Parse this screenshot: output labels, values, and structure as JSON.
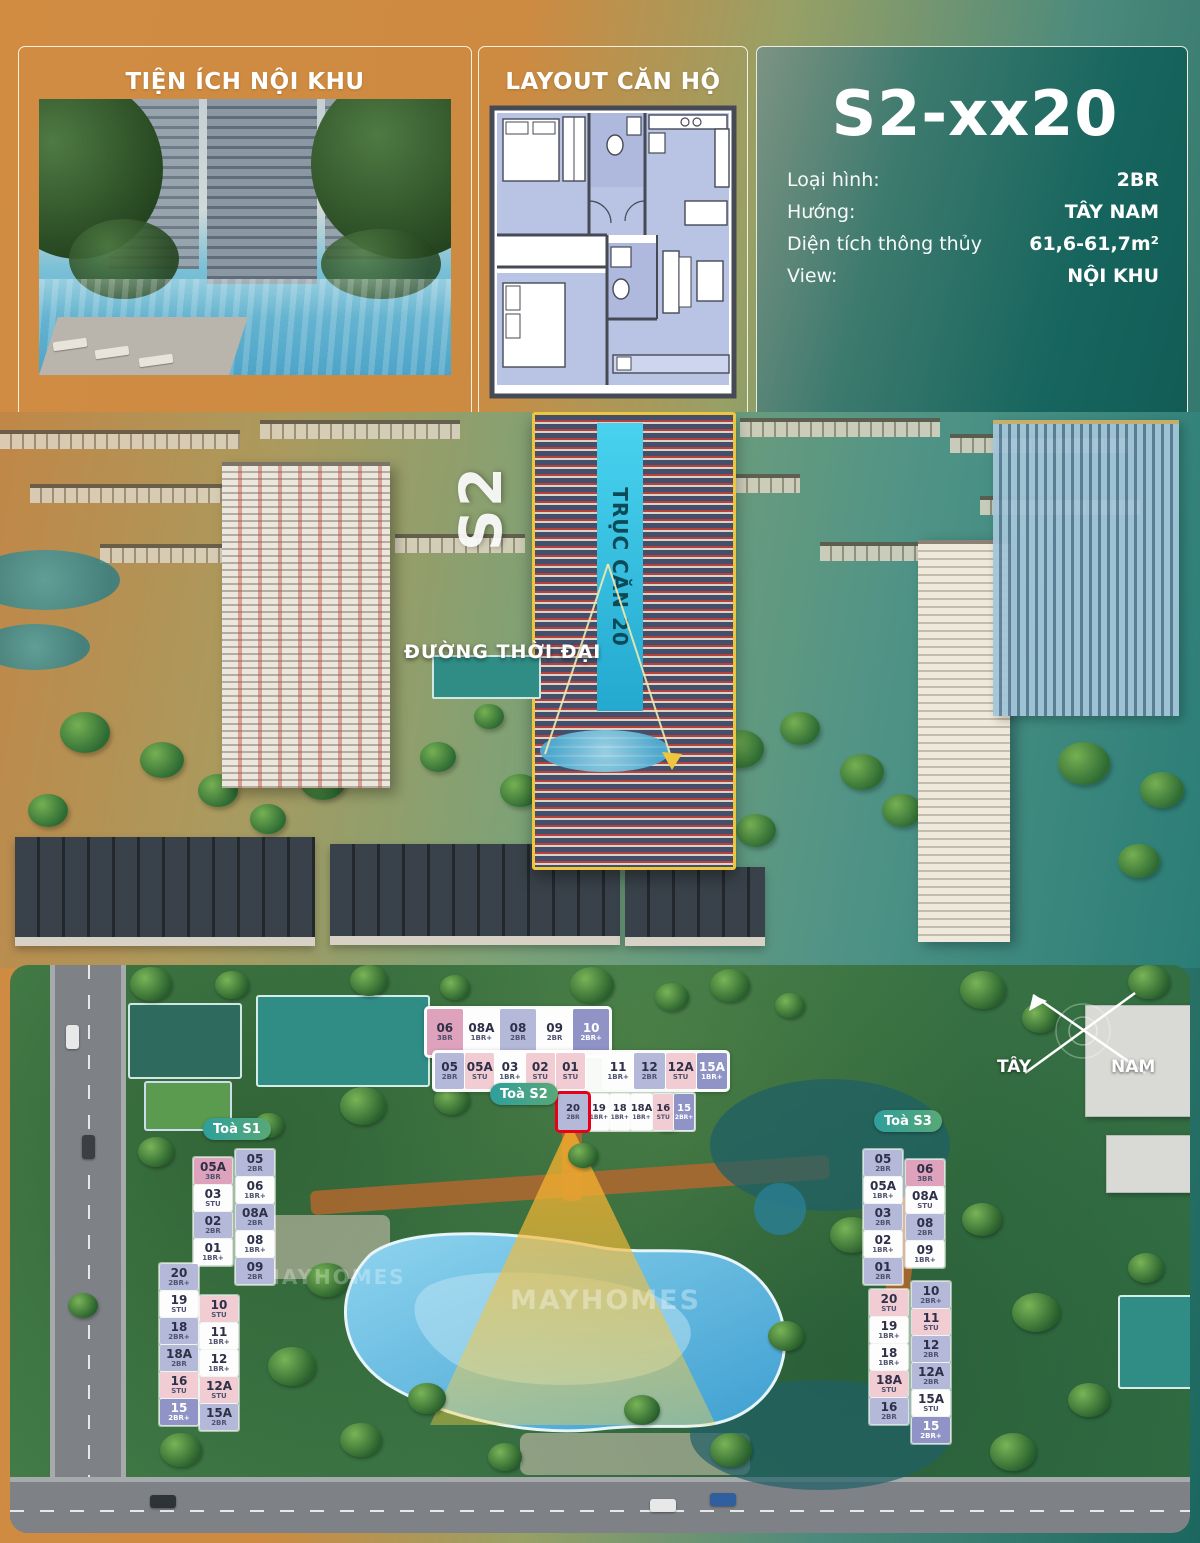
{
  "top": {
    "amenities_title": "TIỆN ÍCH NỘI KHU",
    "layout_title": "LAYOUT CĂN HỘ",
    "unit": {
      "code": "S2-xx20",
      "specs": [
        {
          "label": "Loại hình:",
          "value": "2BR"
        },
        {
          "label": "Hướng:",
          "value": "TÂY NAM"
        },
        {
          "label": "Diện tích thông thủy",
          "value": "61,6-61,7m²"
        },
        {
          "label": "View:",
          "value": "NỘI KHU"
        }
      ]
    }
  },
  "aerial": {
    "tower_code": "S2",
    "axis_label": "TRỤC CĂN 20",
    "road_label": "ĐƯỜNG THỜI ĐẠI"
  },
  "siteplan": {
    "watermark": "MAYHOMES",
    "compass": {
      "west": "TÂY",
      "south": "NAM"
    },
    "pills": {
      "s1": "Toà S1",
      "s2": "Toà S2",
      "s3": "Toà S3"
    },
    "colors": {
      "highlight_red": "#e8001a",
      "type_3br": "#dfa2bc",
      "type_2br": "#b4b8d9",
      "type_2br_plus": "#8f93c5",
      "type_1br_plus": "#fdfdfe",
      "type_stu": "#f1ccd3"
    },
    "grids": {
      "s2_r1": [
        {
          "no": "06",
          "type": "3BR",
          "variant": "pink"
        },
        {
          "no": "08A",
          "type": "1BR+",
          "variant": "white"
        },
        {
          "no": "08",
          "type": "2BR",
          "variant": "lav"
        },
        {
          "no": "09",
          "type": "2BR",
          "variant": "white"
        },
        {
          "no": "10",
          "type": "2BR+",
          "variant": "dark"
        }
      ],
      "s2_r2l": [
        {
          "no": "05",
          "type": "2BR",
          "variant": "lav"
        },
        {
          "no": "05A",
          "type": "STU",
          "variant": "stu"
        },
        {
          "no": "03",
          "type": "1BR+",
          "variant": "white"
        },
        {
          "no": "02",
          "type": "STU",
          "variant": "stu"
        },
        {
          "no": "01",
          "type": "STU",
          "variant": "stu"
        }
      ],
      "s2_r2r": [
        {
          "no": "11",
          "type": "1BR+",
          "variant": "white"
        },
        {
          "no": "12",
          "type": "2BR",
          "variant": "lav"
        },
        {
          "no": "12A",
          "type": "STU",
          "variant": "stu"
        },
        {
          "no": "15A",
          "type": "1BR+",
          "variant": "dark"
        }
      ],
      "s2_r3": [
        {
          "no": "20",
          "type": "2BR",
          "variant": "lav",
          "highlight": true
        },
        {
          "no": "19",
          "type": "1BR+",
          "variant": "white"
        },
        {
          "no": "18",
          "type": "1BR+",
          "variant": "white"
        },
        {
          "no": "18A",
          "type": "1BR+",
          "variant": "white"
        },
        {
          "no": "16",
          "type": "STU",
          "variant": "stu"
        },
        {
          "no": "15",
          "type": "2BR+",
          "variant": "dark"
        }
      ],
      "s1_a": [
        {
          "no": "05A",
          "type": "3BR",
          "variant": "pink"
        },
        {
          "no": "03",
          "type": "STU",
          "variant": "white"
        },
        {
          "no": "02",
          "type": "2BR",
          "variant": "lav"
        },
        {
          "no": "01",
          "type": "1BR+",
          "variant": "white"
        }
      ],
      "s1_b": [
        {
          "no": "05",
          "type": "2BR",
          "variant": "lav"
        },
        {
          "no": "06",
          "type": "1BR+",
          "variant": "white"
        },
        {
          "no": "08A",
          "type": "2BR",
          "variant": "lav"
        },
        {
          "no": "08",
          "type": "1BR+",
          "variant": "white"
        },
        {
          "no": "09",
          "type": "2BR",
          "variant": "lav"
        }
      ],
      "s1_c": [
        {
          "no": "20",
          "type": "2BR+",
          "variant": "lav"
        },
        {
          "no": "19",
          "type": "STU",
          "variant": "white"
        },
        {
          "no": "18",
          "type": "2BR+",
          "variant": "lav"
        },
        {
          "no": "18A",
          "type": "2BR",
          "variant": "lav"
        },
        {
          "no": "16",
          "type": "STU",
          "variant": "stu"
        },
        {
          "no": "15",
          "type": "2BR+",
          "variant": "dark"
        }
      ],
      "s1_d": [
        {
          "no": "10",
          "type": "STU",
          "variant": "stu"
        },
        {
          "no": "11",
          "type": "1BR+",
          "variant": "white"
        },
        {
          "no": "12",
          "type": "1BR+",
          "variant": "white"
        },
        {
          "no": "12A",
          "type": "STU",
          "variant": "stu"
        },
        {
          "no": "15A",
          "type": "2BR",
          "variant": "lav"
        }
      ],
      "s3_a": [
        {
          "no": "05",
          "type": "2BR",
          "variant": "lav"
        },
        {
          "no": "05A",
          "type": "1BR+",
          "variant": "white"
        },
        {
          "no": "03",
          "type": "2BR",
          "variant": "lav"
        },
        {
          "no": "02",
          "type": "1BR+",
          "variant": "white"
        },
        {
          "no": "01",
          "type": "2BR",
          "variant": "lav"
        }
      ],
      "s3_b": [
        {
          "no": "06",
          "type": "3BR",
          "variant": "pink"
        },
        {
          "no": "08A",
          "type": "STU",
          "variant": "white"
        },
        {
          "no": "08",
          "type": "2BR",
          "variant": "lav"
        },
        {
          "no": "09",
          "type": "1BR+",
          "variant": "white"
        }
      ],
      "s3_c": [
        {
          "no": "20",
          "type": "STU",
          "variant": "stu"
        },
        {
          "no": "19",
          "type": "1BR+",
          "variant": "white"
        },
        {
          "no": "18",
          "type": "1BR+",
          "variant": "white"
        },
        {
          "no": "18A",
          "type": "STU",
          "variant": "stu"
        },
        {
          "no": "16",
          "type": "2BR",
          "variant": "lav"
        }
      ],
      "s3_d": [
        {
          "no": "10",
          "type": "2BR+",
          "variant": "lav"
        },
        {
          "no": "11",
          "type": "STU",
          "variant": "stu"
        },
        {
          "no": "12",
          "type": "2BR",
          "variant": "lav"
        },
        {
          "no": "12A",
          "type": "2BR",
          "variant": "lav"
        },
        {
          "no": "15A",
          "type": "STU",
          "variant": "white"
        },
        {
          "no": "15",
          "type": "2BR+",
          "variant": "dark"
        }
      ]
    }
  }
}
